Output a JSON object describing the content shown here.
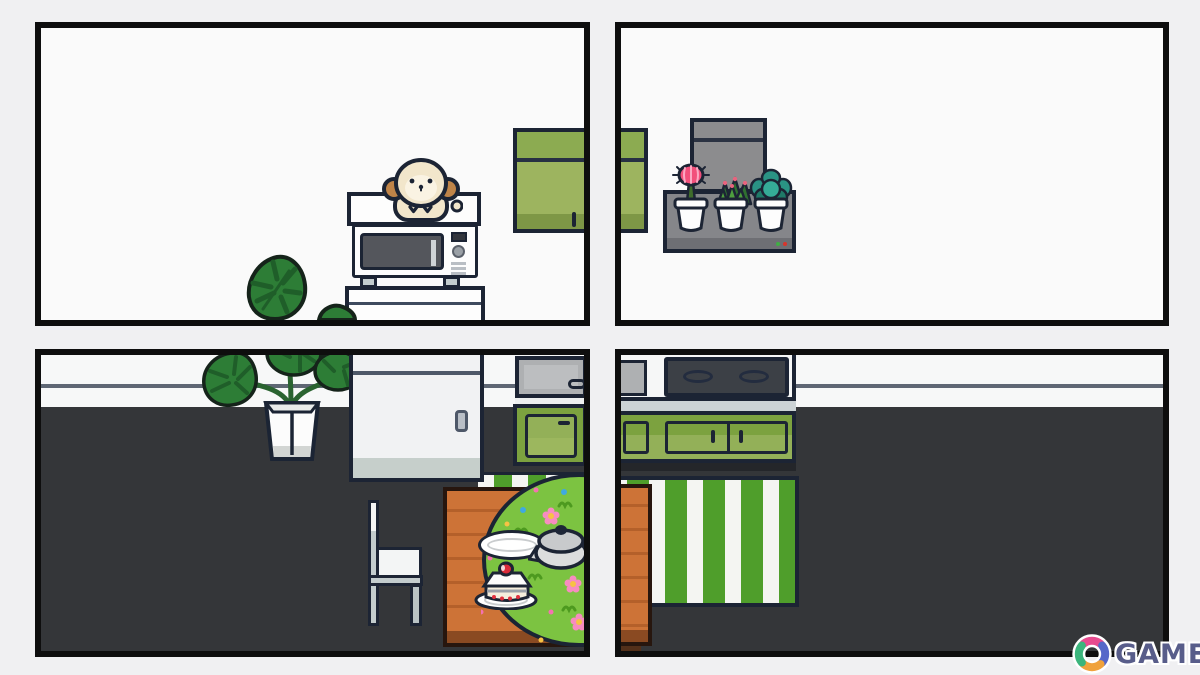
{
  "scene": {
    "description": "four-screenshot collage of a cozy top-down room decorating game, kitchen scenes",
    "panel_count": 4
  },
  "watermark": {
    "text": "GAMER"
  },
  "colors": {
    "bg": "#f0f0f2",
    "panelBorder": "#0e0e0e",
    "panelBg": "#fafafa",
    "ink": "#1c2434",
    "floor": "#343639",
    "wallWhite": "#f7f8f8",
    "wallLine": "#5f6774",
    "fridgeWhite": "#f1f2f3",
    "fridgeBottom": "#c6cfcb",
    "cabinetGreenTop": "#8cab51",
    "cabinetGreenMid": "#9db45f",
    "cabinetGreenDark": "#7e9746",
    "baseCabGreen": "#7ca23f",
    "baseCabGreenLight": "#93b058",
    "counterGray": "#aeb0b2",
    "stoveTop": "#3c4046",
    "rugGreen": "#4f9e2b",
    "rugWhite": "#f4f5f2",
    "wood": "#cd7337",
    "woodLine": "#b4602a",
    "woodDark": "#8a4a22",
    "matGreen": "#7cc341",
    "machineGray": "#8c8c8e",
    "shelfGray": "#85868a",
    "shelfBarGray": "#6e6f74",
    "dogCream": "#f2e6cb",
    "dogEar": "#bf8448",
    "microDoor": "#54565c",
    "chairLight": "#f3f5f5",
    "chairGray": "#c3cccd",
    "logoText": "#585d8a",
    "logoPink": "#e84a8f",
    "logoGreen": "#3bb57c",
    "logoIndigo": "#5668c9",
    "logoOrange": "#f0a23c",
    "cactusPink": "#f2507b",
    "succulentGreen": "#4e9e3f",
    "echeveriaTeal": "#2a9384"
  },
  "panels": {
    "top_left": {
      "view": "wall front view",
      "items": [
        "monstera leaves",
        "microwave cart",
        "microwave oven",
        "cream puppy peeking",
        "green wall cabinet"
      ]
    },
    "top_right": {
      "view": "wall front view",
      "items": [
        "green wall cabinet edge",
        "gray appliance",
        "gray wall shelf with status lights",
        "pink moon cactus pot",
        "green succulent pot",
        "teal echeveria pot"
      ]
    },
    "bottom_left": {
      "view": "top-down floor view",
      "items": [
        "potted monstera",
        "refrigerator",
        "sink counter",
        "green base cabinet",
        "striped rug edge",
        "wooden dining table",
        "green flower mat",
        "empty plate",
        "cooking pot",
        "cake slice on plate",
        "white chair"
      ]
    },
    "bottom_right": {
      "view": "top-down floor view",
      "items": [
        "sink edge",
        "stove top with two burners",
        "green base cabinets",
        "green striped rug",
        "wooden table edge"
      ]
    }
  }
}
